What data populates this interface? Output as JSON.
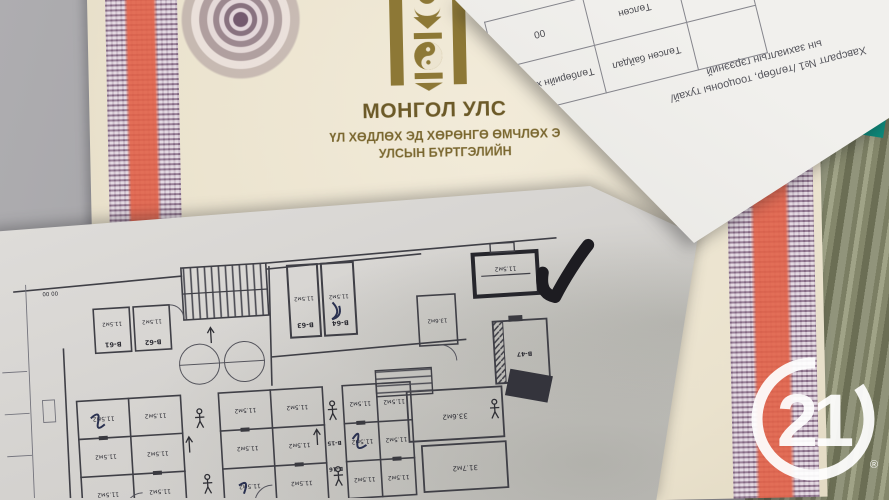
{
  "certificate": {
    "country_title": "МОНГОЛ УЛС",
    "doc_line1": "ҮЛ ХӨДЛӨХ ЭД ХӨРӨНГӨ ӨМЧЛӨХ Э",
    "doc_line2": "УЛСЫН БҮРТГЭЛИЙН",
    "colors": {
      "paper": "#ece4d0",
      "guilloche_purple": "#684868",
      "stripe_red": "#e2624a",
      "emblem_gold": "#8d7836",
      "title_text": "#6c5a28"
    }
  },
  "attachment_sheet": {
    "caption_line1": "Хавсралт №1 /төлбөр, тооцооны тухай/",
    "caption_line2": "ын захиалгын гэрээний",
    "table": {
      "headers": [
        "",
        "Төлсөн байдал",
        "Төлбөрийн хэмжээ"
      ],
      "values": [
        "Төлсөн",
        "Төлсөн",
        "00"
      ]
    }
  },
  "floor_plan": {
    "area_small": "11.5м2",
    "area_136": "13.6м2",
    "area_336": "33.6м2",
    "area_317": "31.7м2",
    "dim_label": "00 00",
    "rooms": {
      "b61": "В-61",
      "b62": "В-62",
      "b63": "В-63",
      "b64": "В-64",
      "b47": "В-47",
      "b15": "В-15",
      "b16": "В-16"
    }
  },
  "watermark": {
    "number": "21",
    "registered": "®",
    "color": "#ffffff"
  }
}
